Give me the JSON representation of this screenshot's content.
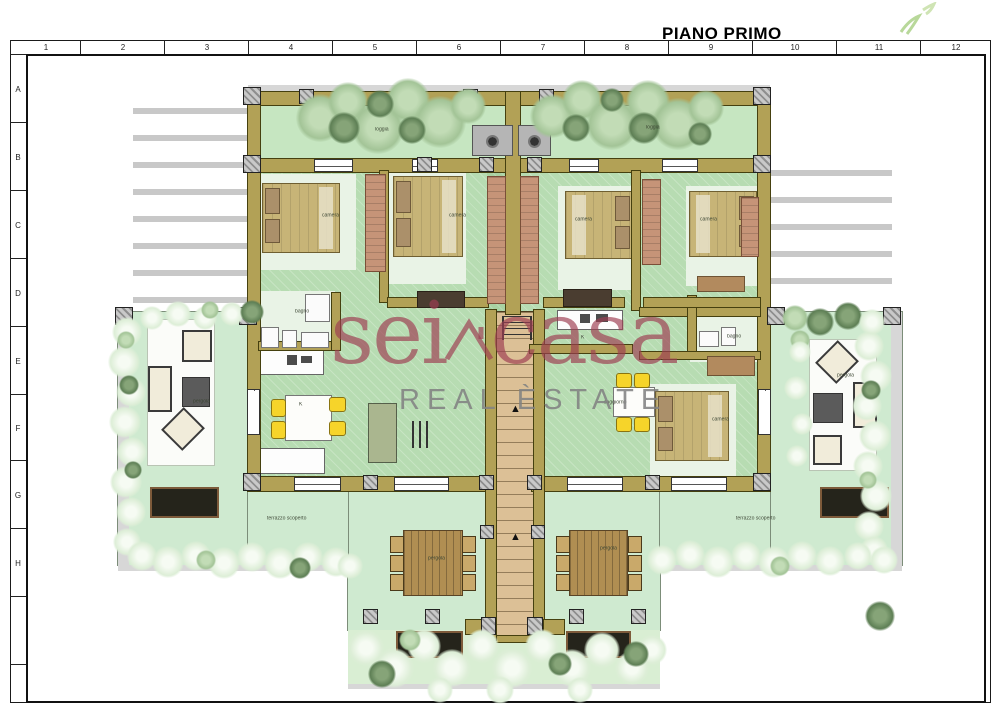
{
  "page": {
    "title": "PIANO PRIMO"
  },
  "ruler": {
    "columns": [
      "1",
      "2",
      "3",
      "4",
      "5",
      "6",
      "7",
      "8",
      "9",
      "10",
      "11",
      "12"
    ],
    "rows": [
      "A",
      "B",
      "C",
      "D",
      "E",
      "F",
      "G",
      "H"
    ]
  },
  "watermark": {
    "brand_left": "sei",
    "brand_right": "casa",
    "house_icon": "house-roof-icon",
    "subtitle": "REAL ÈSTATE",
    "brand_color": "#a34a5e",
    "subtitle_color": "#8e8e8e"
  },
  "plan": {
    "room_labels": [
      {
        "text": "loggia",
        "x": 375,
        "y": 127
      },
      {
        "text": "loggia",
        "x": 646,
        "y": 125
      },
      {
        "text": "camera",
        "x": 322,
        "y": 213
      },
      {
        "text": "camera",
        "x": 449,
        "y": 213
      },
      {
        "text": "camera",
        "x": 575,
        "y": 217
      },
      {
        "text": "camera",
        "x": 700,
        "y": 217
      },
      {
        "text": "camera",
        "x": 712,
        "y": 417
      },
      {
        "text": "bagno",
        "x": 295,
        "y": 309
      },
      {
        "text": "bagno",
        "x": 727,
        "y": 334
      },
      {
        "text": "K",
        "x": 299,
        "y": 402
      },
      {
        "text": "K",
        "x": 581,
        "y": 335
      },
      {
        "text": "soggiorno",
        "x": 604,
        "y": 400
      },
      {
        "text": "pergola",
        "x": 193,
        "y": 399
      },
      {
        "text": "pergola",
        "x": 837,
        "y": 373
      },
      {
        "text": "pergola",
        "x": 428,
        "y": 556
      },
      {
        "text": "pergola",
        "x": 600,
        "y": 546
      },
      {
        "text": "terrazzo scoperto",
        "x": 267,
        "y": 516
      },
      {
        "text": "terrazzo scoperto",
        "x": 736,
        "y": 516
      }
    ],
    "colors": {
      "wall": "#b2a156",
      "terrace": "#cfead0",
      "interior": "#b7dcb2",
      "stairs": "#dcc096",
      "bed": "#c7b477",
      "wardrobe": "#c69478",
      "chair_accent": "#f6d42a",
      "lounger": "#25241b"
    }
  }
}
